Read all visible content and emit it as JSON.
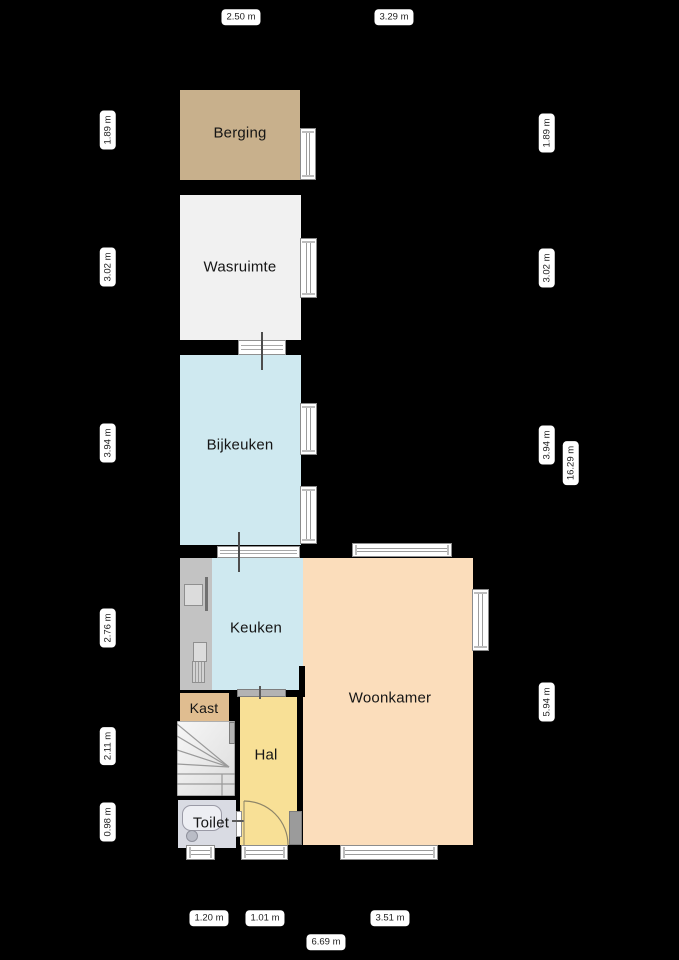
{
  "title": "Begane grond plattegrond",
  "rooms": {
    "berging": {
      "label": "Berging"
    },
    "wasruimte": {
      "label": "Wasruimte"
    },
    "bijkeuken": {
      "label": "Bijkeuken"
    },
    "keuken": {
      "label": "Keuken"
    },
    "woonkamer": {
      "label": "Woonkamer"
    },
    "kast": {
      "label": "Kast"
    },
    "hal": {
      "label": "Hal"
    },
    "toilet": {
      "label": "Toilet"
    }
  },
  "dimensions": {
    "top": [
      {
        "label": "2.50 m"
      },
      {
        "label": "3.29 m"
      }
    ],
    "bottom": [
      {
        "label": "1.20 m"
      },
      {
        "label": "1.01 m"
      },
      {
        "label": "3.51 m"
      },
      {
        "label": "6.69 m"
      }
    ],
    "left": [
      {
        "label": "1.89 m"
      },
      {
        "label": "3.02 m"
      },
      {
        "label": "3.94 m"
      },
      {
        "label": "2.76 m"
      },
      {
        "label": "2.11 m"
      },
      {
        "label": "0.98 m"
      }
    ],
    "right": [
      {
        "label": "1.89 m"
      },
      {
        "label": "3.02 m"
      },
      {
        "label": "3.94 m"
      },
      {
        "label": "16.29 m"
      },
      {
        "label": "5.94 m"
      }
    ]
  },
  "colors": {
    "background": "#000000",
    "berging": "#c8b08c",
    "wasruimte": "#f1f1f1",
    "bijkeuken": "#cfe9f0",
    "keuken": "#cfe9f0",
    "woonkamer": "#fbddbb",
    "kast": "#e0bd90",
    "hal": "#f8e096",
    "toilet": "#d9dbe3",
    "stairs": "#efefef",
    "window_frame": "#ffffff",
    "dimension_pill": "#ffffff"
  }
}
